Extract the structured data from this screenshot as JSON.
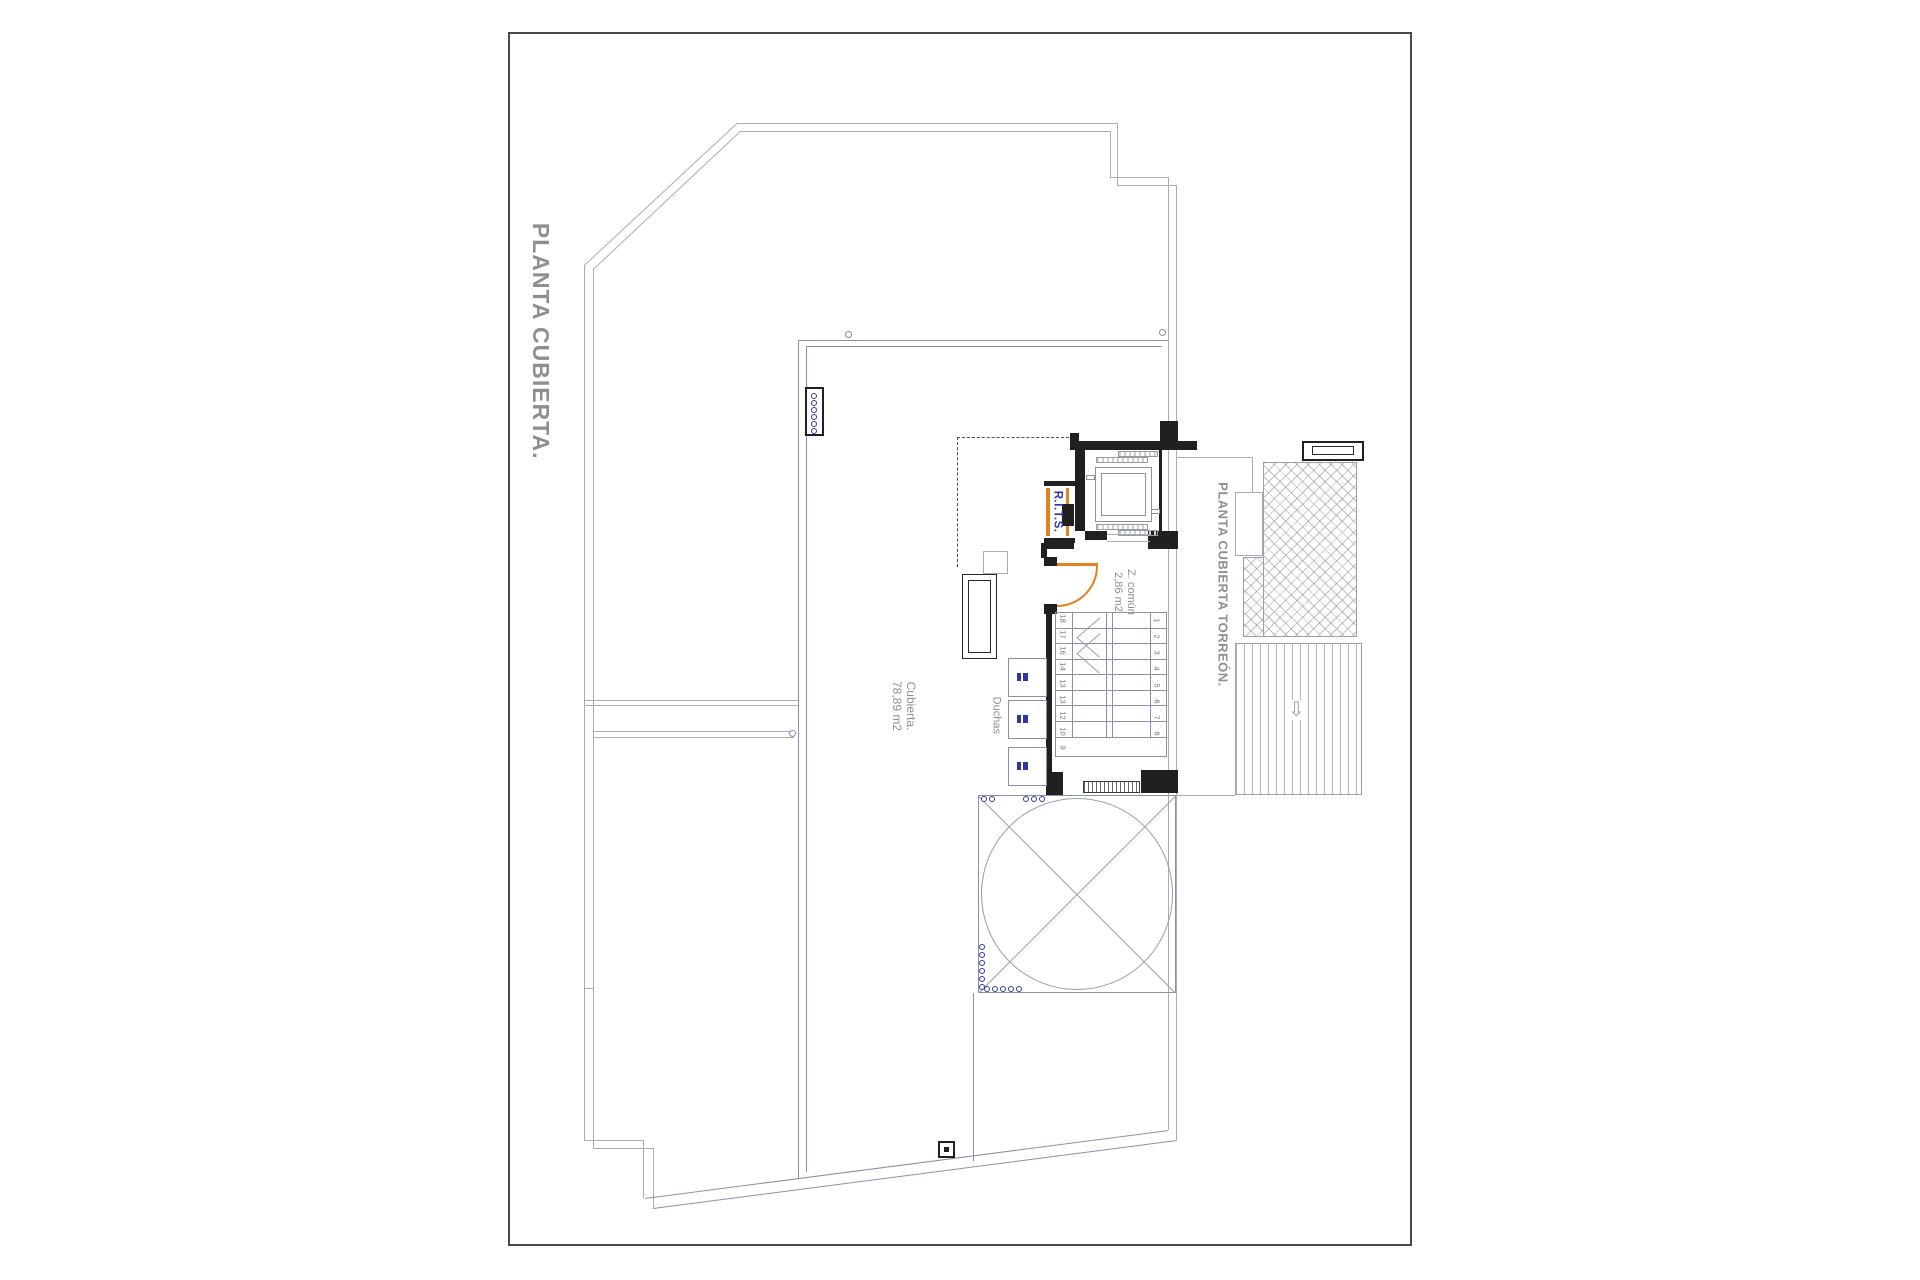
{
  "title": "PLANTA CUBIERTA.",
  "torreon_title": "PLANTA CUBIERTA TORREÓN.",
  "labels": {
    "terrace_line1": "Cubierta.",
    "terrace_line2": "78,89 m2",
    "showers": "Duchas",
    "zone_line1": "Z. común",
    "zone_line2": "2,86 m2",
    "rits": "R.I.T.S.",
    "slope_arrow": "⇩"
  },
  "stairs": {
    "left_numbers": [
      "18",
      "17",
      "16",
      "14",
      "13",
      "13",
      "12",
      "10",
      "9"
    ],
    "right_numbers": [
      "1",
      "2",
      "3",
      "4",
      "5",
      "6",
      "7",
      "8"
    ]
  },
  "colors": {
    "outline": "#a9adb5",
    "parapet": "#8a90aa",
    "wall": "#202022",
    "orange": "#e0821e",
    "blue": "#2e38a8",
    "textgray": "#8f8f8f",
    "hatch": "#9aa0b0"
  }
}
